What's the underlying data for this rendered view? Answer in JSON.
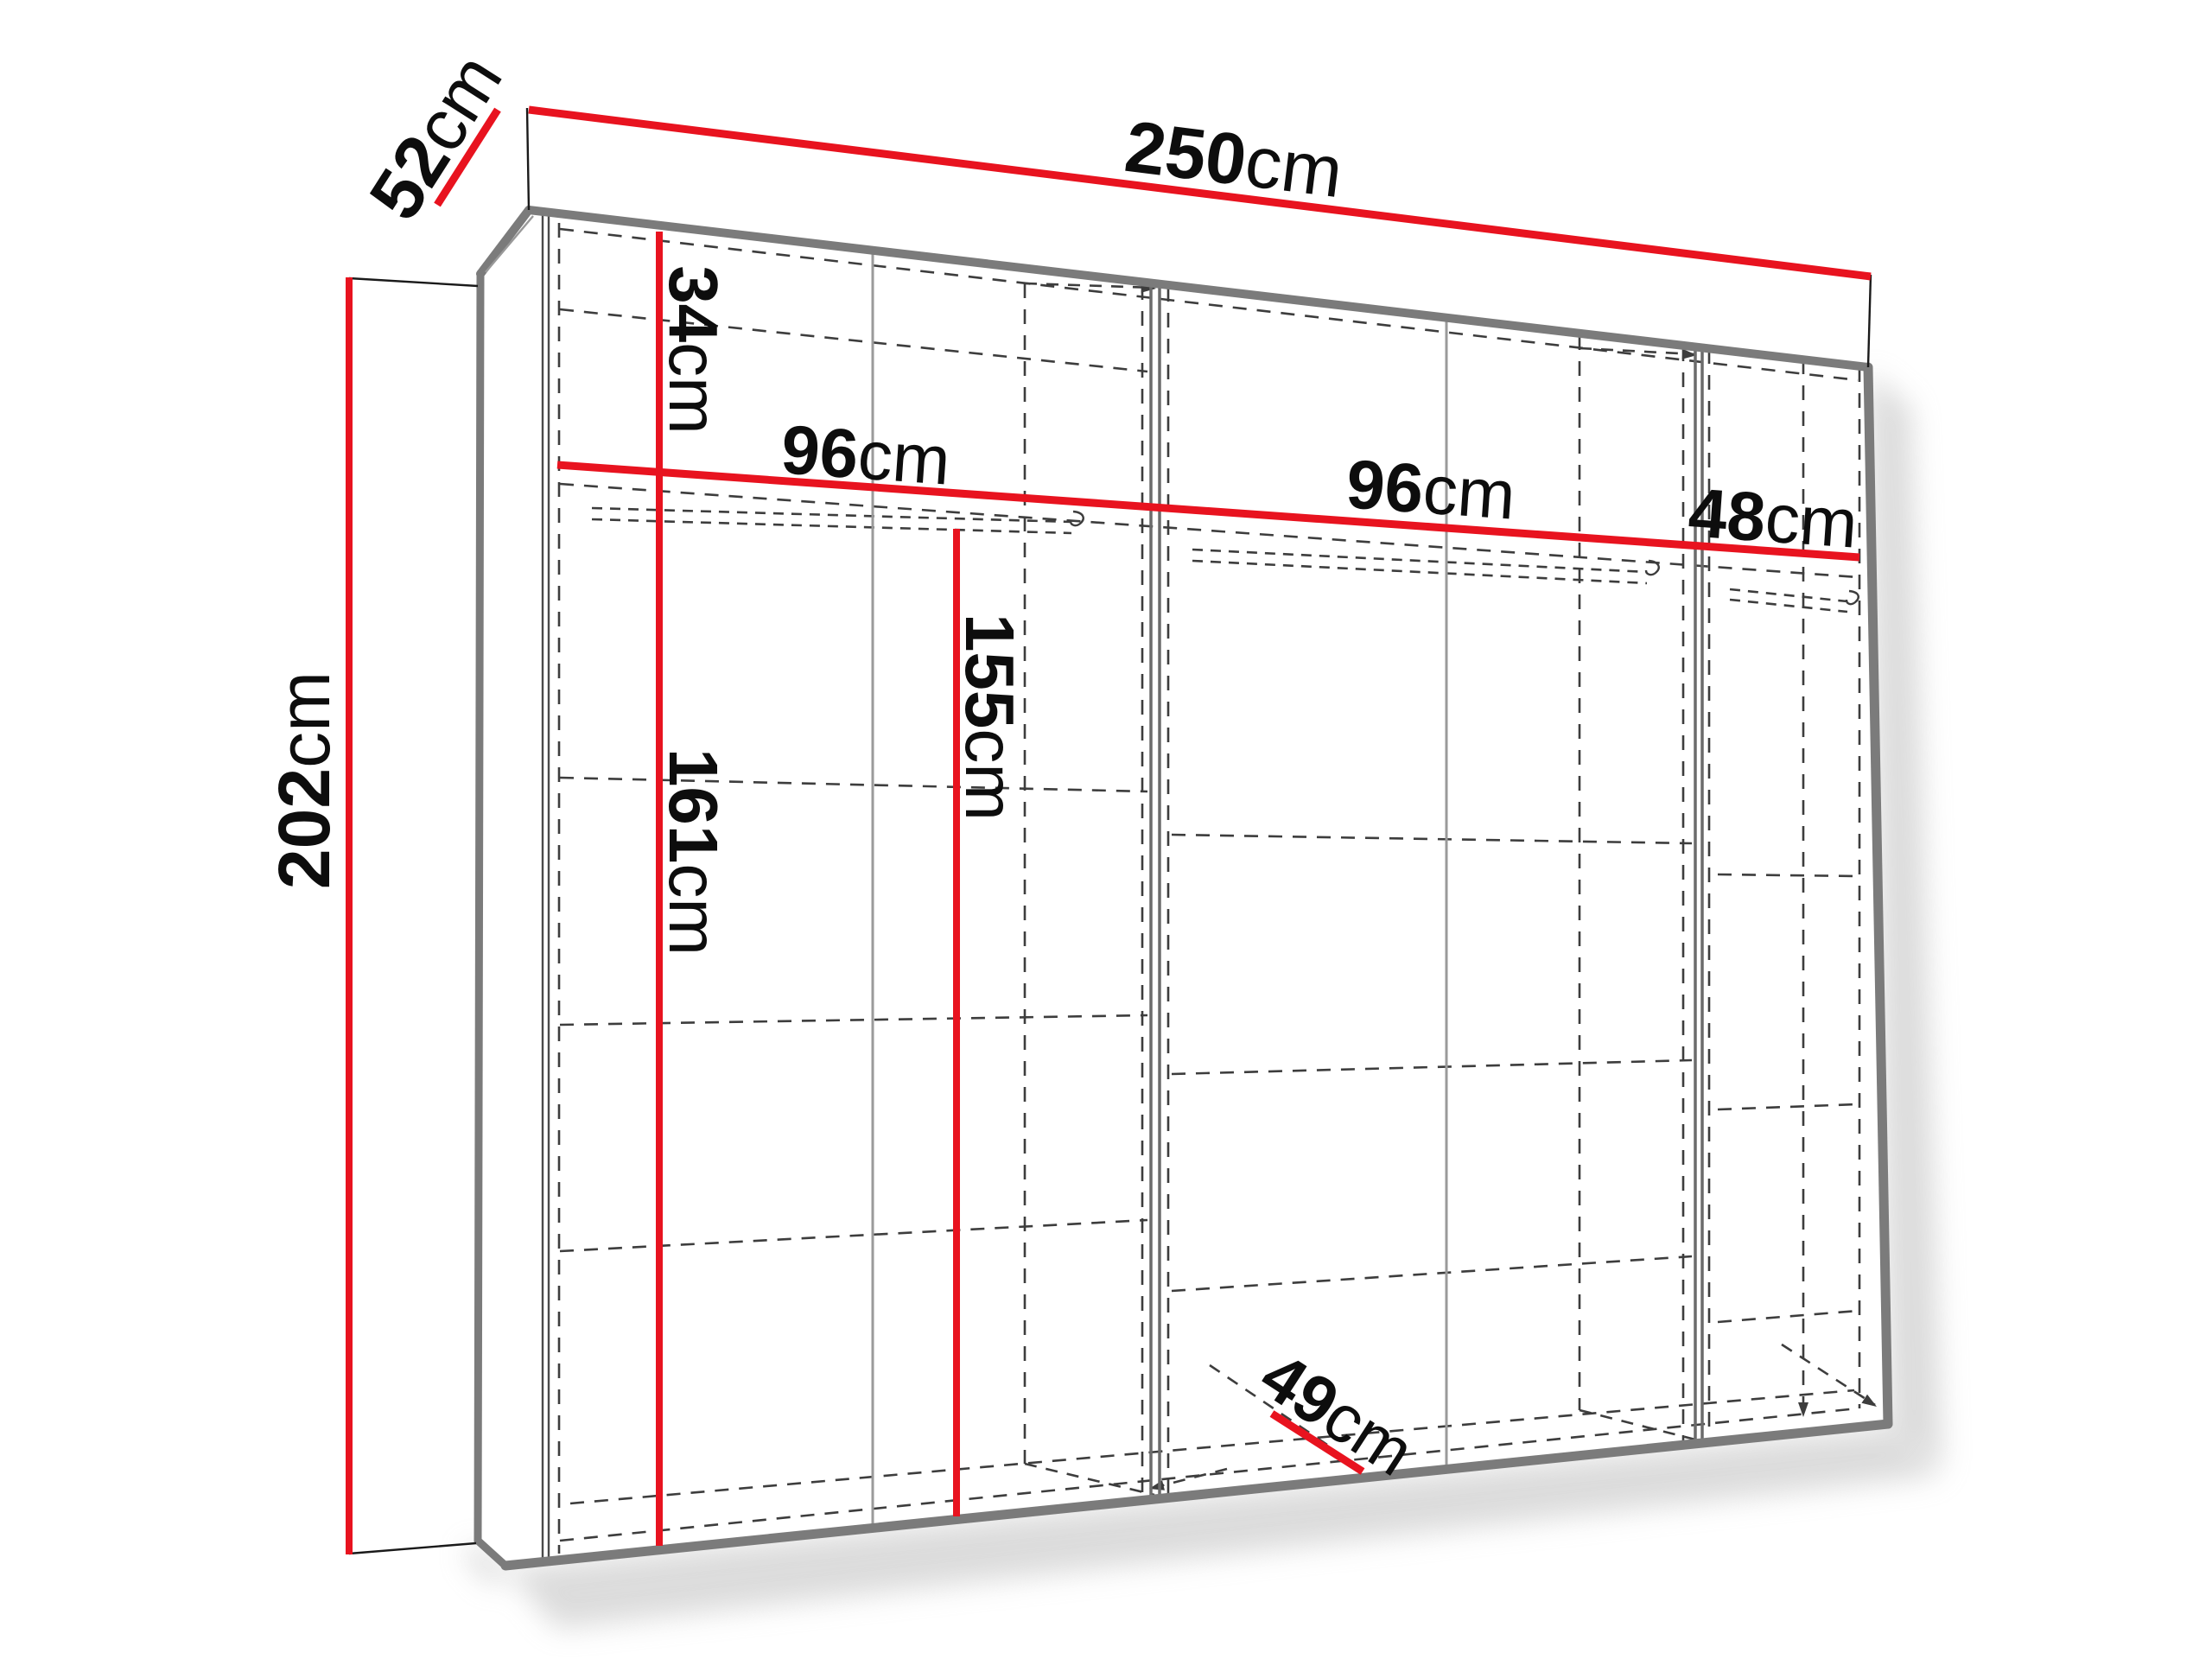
{
  "colors": {
    "dimension_line": "#e8131f",
    "edge_gray": "#7b7b7b",
    "panel_line": "#6b6b6b",
    "seam_line": "#9a9a9a",
    "hidden_line": "#3d3d3d",
    "tick_line": "#1a1a1a",
    "label_text": "#0d0d0d",
    "shadow": "#bfbfbf",
    "face": "#ffffff"
  },
  "dimensions": {
    "width": {
      "value": "250",
      "unit": "cm"
    },
    "depth": {
      "value": "52",
      "unit": "cm"
    },
    "height": {
      "value": "202",
      "unit": "cm"
    },
    "top_shelf_drop": {
      "value": "34",
      "unit": "cm"
    },
    "section_left_width": {
      "value": "96",
      "unit": "cm"
    },
    "section_middle_width": {
      "value": "96",
      "unit": "cm"
    },
    "section_right_width": {
      "value": "48",
      "unit": "cm"
    },
    "hanging_height_left": {
      "value": "161",
      "unit": "cm"
    },
    "hanging_height_middle": {
      "value": "155",
      "unit": "cm"
    },
    "interior_depth": {
      "value": "49",
      "unit": "cm"
    }
  }
}
